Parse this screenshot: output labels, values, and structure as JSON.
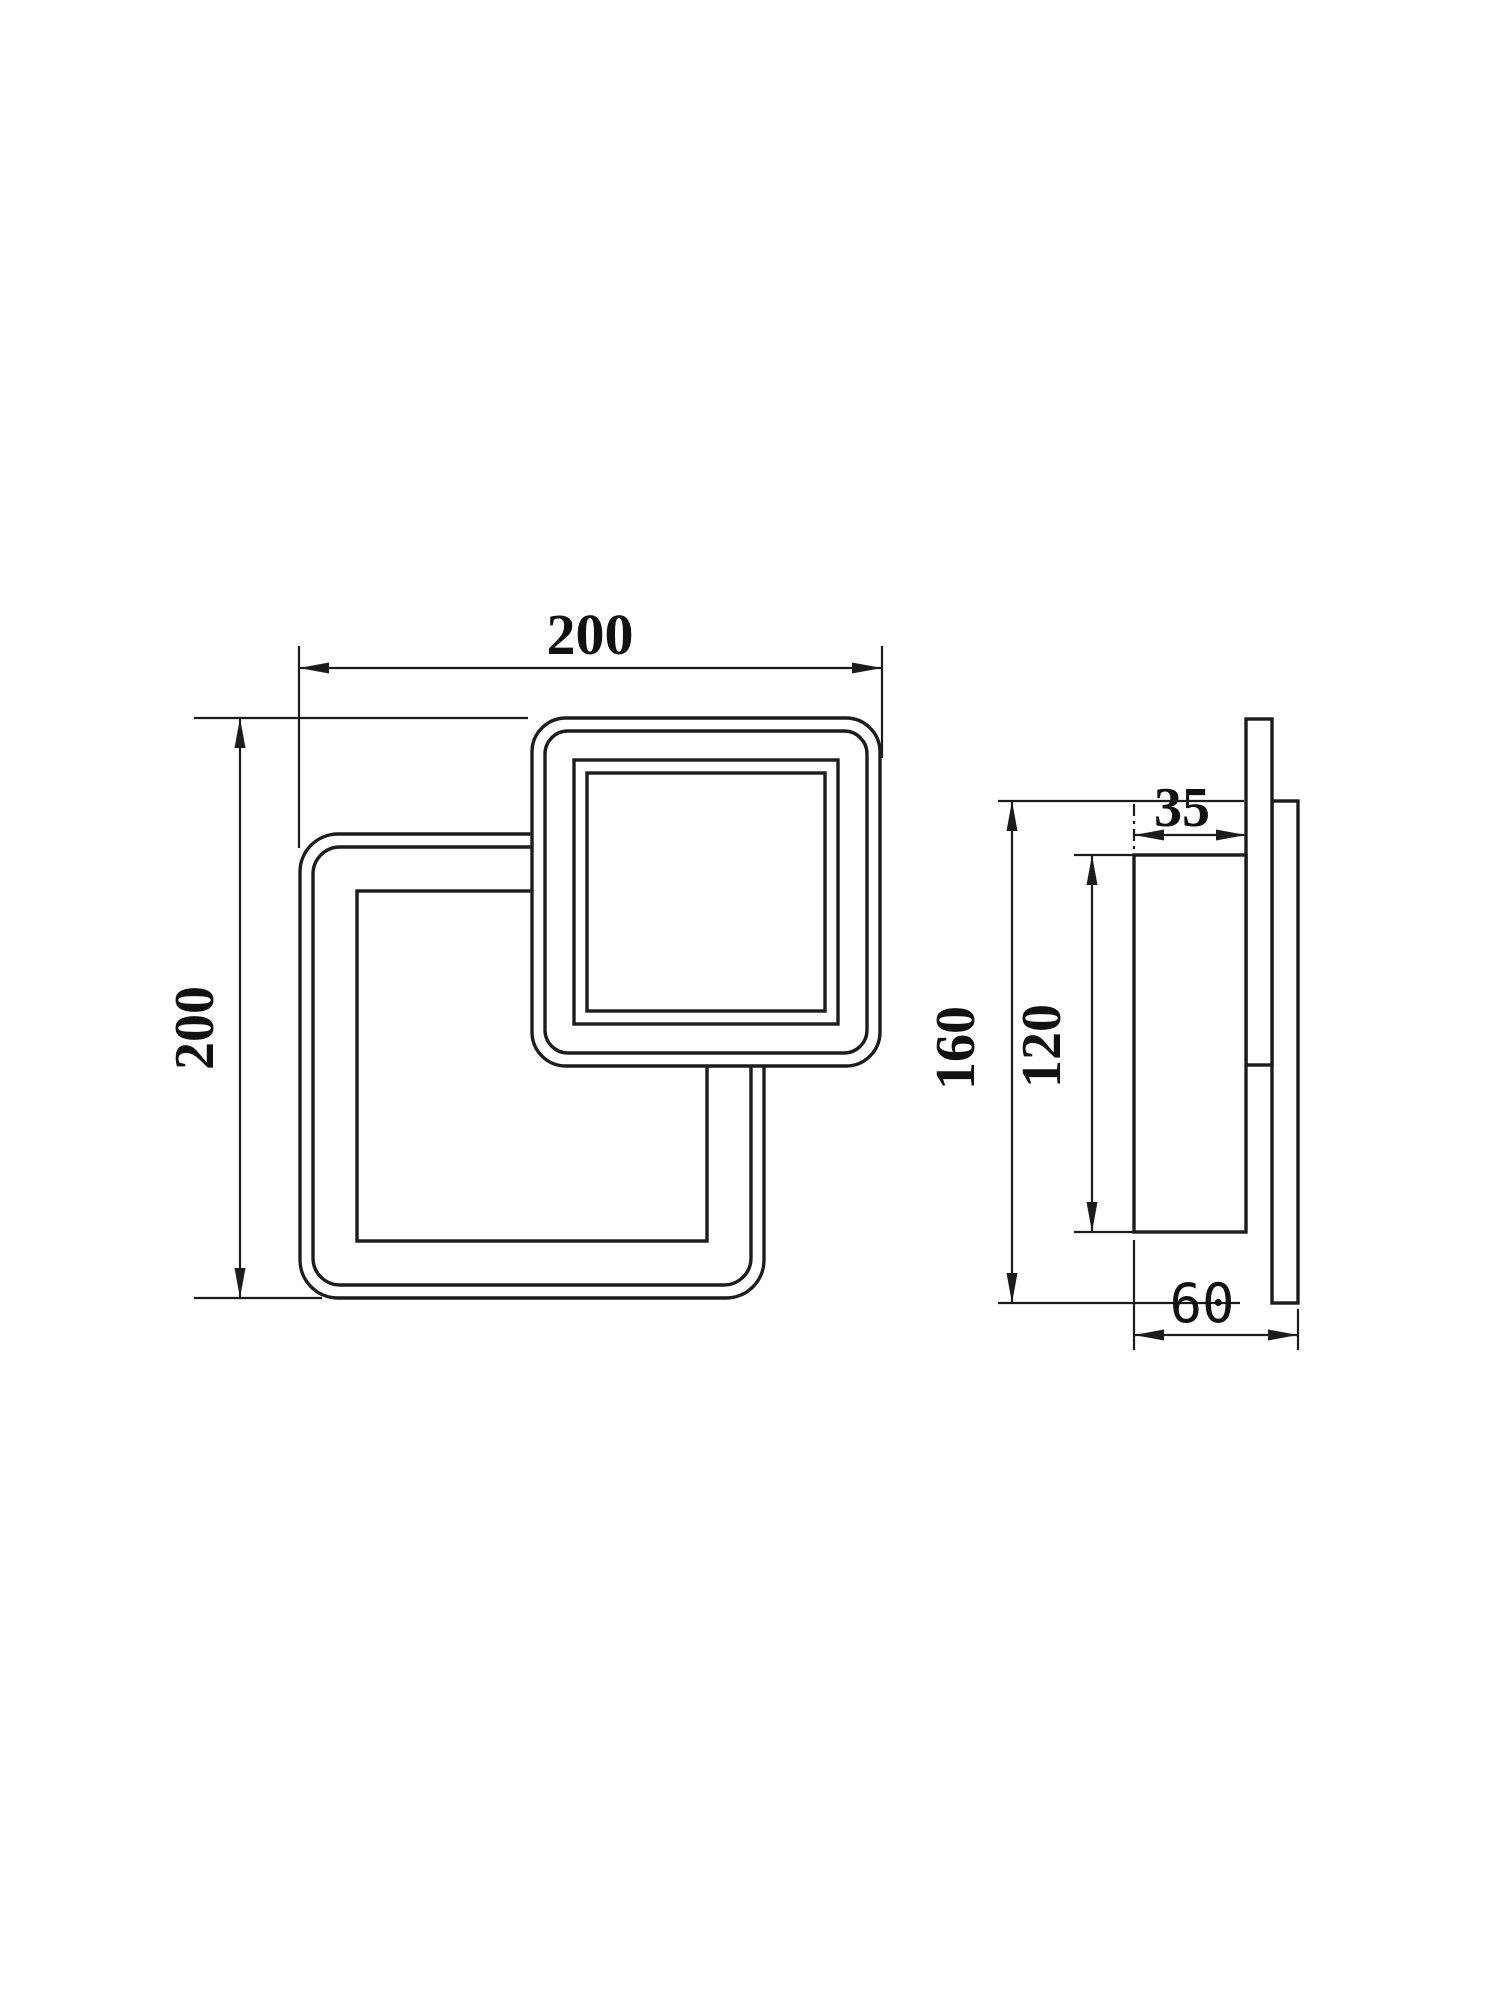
{
  "page": {
    "background_color": "#ffffff",
    "line_color": "#1c1c1c"
  },
  "drawing": {
    "type": "technical-dimension-drawing",
    "front_view": {
      "width_label": "200",
      "height_label": "200"
    },
    "side_view": {
      "front_depth_label": "35",
      "rear_height_label": "160",
      "front_height_label": "120",
      "total_depth_label": "60"
    }
  }
}
